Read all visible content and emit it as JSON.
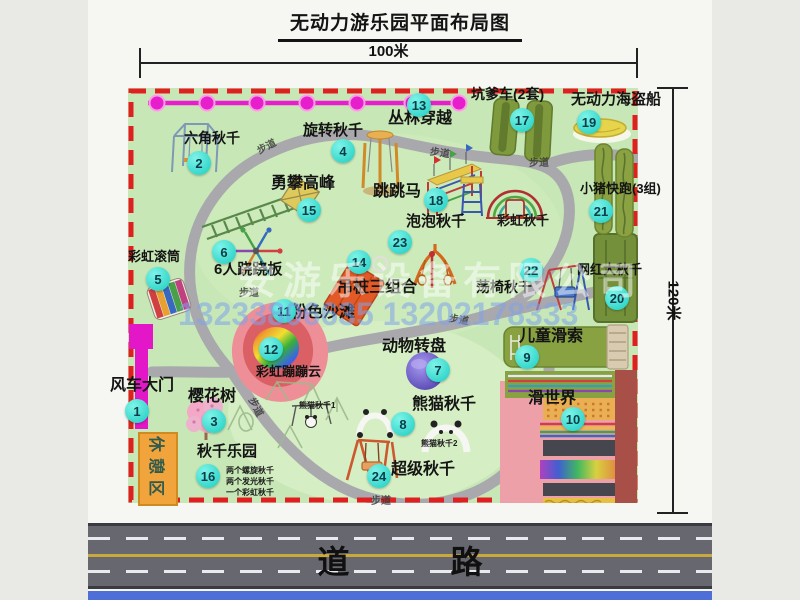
{
  "title": "无动力游乐园平面布局图",
  "dimensions": {
    "width": "100米",
    "height": "120米"
  },
  "road": {
    "label": "道 路"
  },
  "watermark": {
    "company": "安游乐设备有限公司",
    "phone": "13233806635 13202178333"
  },
  "rest_area": {
    "label": "休憩区"
  },
  "attractions": [
    {
      "num": "1",
      "name": "风车大门",
      "cx": 137,
      "cy": 411,
      "lx": 110,
      "ly": 378,
      "fs": 16
    },
    {
      "num": "2",
      "name": "六角秋千",
      "cx": 199,
      "cy": 163,
      "lx": 184,
      "ly": 131,
      "fs": 14
    },
    {
      "num": "3",
      "name": "樱花树",
      "cx": 214,
      "cy": 421,
      "lx": 188,
      "ly": 389,
      "fs": 16
    },
    {
      "num": "4",
      "name": "旋转秋千",
      "cx": 343,
      "cy": 151,
      "lx": 303,
      "ly": 123,
      "fs": 15
    },
    {
      "num": "5",
      "name": "彩虹滚筒",
      "cx": 158,
      "cy": 279,
      "lx": 128,
      "ly": 250,
      "fs": 13
    },
    {
      "num": "6",
      "name": "6人跷跷板",
      "cx": 224,
      "cy": 252,
      "lx": 214,
      "ly": 262,
      "fs": 15
    },
    {
      "num": "7",
      "name": "动物转盘",
      "cx": 438,
      "cy": 370,
      "lx": 382,
      "ly": 339,
      "fs": 16
    },
    {
      "num": "8",
      "name": "熊猫秋千",
      "cx": 403,
      "cy": 424,
      "lx": 412,
      "ly": 397,
      "fs": 16
    },
    {
      "num": "9",
      "name": "儿童滑索",
      "cx": 527,
      "cy": 357,
      "lx": 519,
      "ly": 329,
      "fs": 16
    },
    {
      "num": "10",
      "name": "滑世界",
      "cx": 573,
      "cy": 419,
      "lx": 528,
      "ly": 391,
      "fs": 16
    },
    {
      "num": "11",
      "name": "粉色沙滩",
      "cx": 284,
      "cy": 311,
      "lx": 291,
      "ly": 305,
      "fs": 16
    },
    {
      "num": "12",
      "name": "彩虹蹦蹦云",
      "cx": 271,
      "cy": 349,
      "lx": 256,
      "ly": 365,
      "fs": 13
    },
    {
      "num": "13",
      "name": "丛林穿越",
      "cx": 419,
      "cy": 105,
      "lx": 388,
      "ly": 111,
      "fs": 16
    },
    {
      "num": "14",
      "name": "吊桩三组合",
      "cx": 359,
      "cy": 262,
      "lx": 337,
      "ly": 280,
      "fs": 16
    },
    {
      "num": "15",
      "name": "勇攀高峰",
      "cx": 309,
      "cy": 210,
      "lx": 271,
      "ly": 176,
      "fs": 16
    },
    {
      "num": "16",
      "name": "秋千乐园",
      "cx": 208,
      "cy": 476,
      "lx": 197,
      "ly": 444,
      "fs": 15
    },
    {
      "num": "17",
      "name": "坑爹车(2套)",
      "cx": 522,
      "cy": 120,
      "lx": 471,
      "ly": 87,
      "fs": 14
    },
    {
      "num": "18",
      "name": "跳跳马",
      "cx": 436,
      "cy": 200,
      "lx": 373,
      "ly": 184,
      "fs": 16
    },
    {
      "num": "19",
      "name": "无动力海盗船",
      "cx": 589,
      "cy": 122,
      "lx": 571,
      "ly": 92,
      "fs": 15
    },
    {
      "num": "20",
      "name": "网红大秋千",
      "cx": 617,
      "cy": 298,
      "lx": 577,
      "ly": 263,
      "fs": 13
    },
    {
      "num": "21",
      "name": "小猪快跑(3组)",
      "cx": 601,
      "cy": 211,
      "lx": 580,
      "ly": 182,
      "fs": 13
    },
    {
      "num": "22",
      "name": "荡椅秋千",
      "cx": 531,
      "cy": 270,
      "lx": 476,
      "ly": 280,
      "fs": 14
    },
    {
      "num": "23",
      "name": "泡泡秋千",
      "cx": 400,
      "cy": 242,
      "lx": 406,
      "ly": 214,
      "fs": 15
    },
    {
      "num": "24",
      "name": "超级秋千",
      "cx": 379,
      "cy": 476,
      "lx": 391,
      "ly": 462,
      "fs": 16
    }
  ],
  "extra_labels": [
    {
      "text": "彩虹秋千",
      "x": 497,
      "y": 214,
      "fs": 13
    },
    {
      "text": "熊猫秋千1",
      "x": 299,
      "y": 402,
      "fs": 8
    },
    {
      "text": "熊猫秋千2",
      "x": 421,
      "y": 440,
      "fs": 8
    },
    {
      "text": "两个螺旋秋千",
      "x": 226,
      "y": 467,
      "fs": 8
    },
    {
      "text": "两个发光秋千",
      "x": 226,
      "y": 478,
      "fs": 8
    },
    {
      "text": "一个彩虹秋千",
      "x": 226,
      "y": 489,
      "fs": 8
    }
  ],
  "path_labels": [
    {
      "text": "步道",
      "x": 256,
      "y": 138,
      "rot": -28
    },
    {
      "text": "步道",
      "x": 430,
      "y": 144,
      "rot": 8
    },
    {
      "text": "步道",
      "x": 529,
      "y": 154,
      "rot": 0
    },
    {
      "text": "步道",
      "x": 239,
      "y": 284,
      "rot": 0
    },
    {
      "text": "步道",
      "x": 449,
      "y": 311,
      "rot": 10
    },
    {
      "text": "步道",
      "x": 247,
      "y": 399,
      "rot": 62
    },
    {
      "text": "步道",
      "x": 371,
      "y": 492,
      "rot": 0
    }
  ]
}
